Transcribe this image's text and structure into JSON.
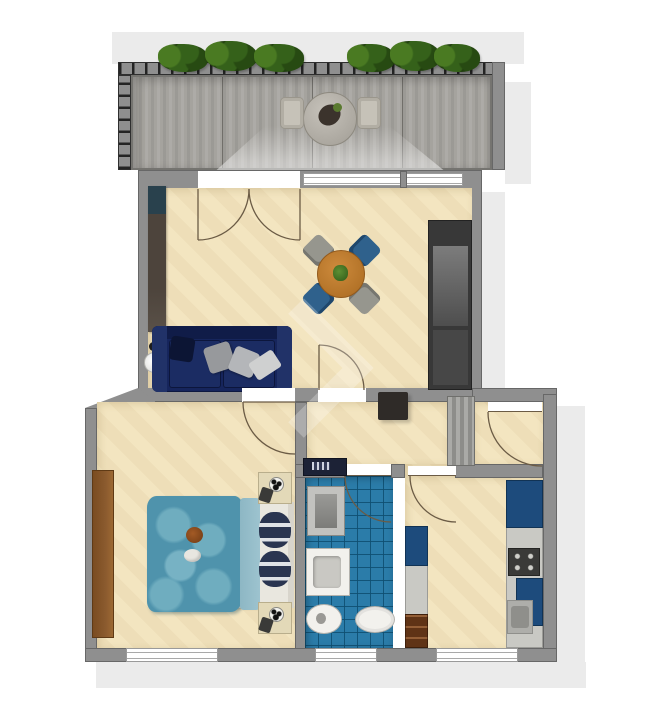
{
  "plan": {
    "view": "top-down 3D rendered apartment floor plan, no text labels",
    "rooms": [
      {
        "id": "balcony",
        "label": "Balcony",
        "items": [
          "wood plank decking",
          "railing with 6 planter boxes of greenery",
          "round bistro table with tray",
          "2 outdoor chairs"
        ]
      },
      {
        "id": "living-room",
        "label": "Living room",
        "items": [
          "navy three-seat sofa with gray cushions and white throw",
          "round wood dining table with centerpiece plant",
          "4 dining chairs (2 gray, 2 blue)",
          "dark sideboard along left wall",
          "white floor lamp",
          "dark built-in niche on right wall"
        ]
      },
      {
        "id": "bedroom",
        "label": "Bedroom",
        "items": [
          "double bed with teal patterned duvet",
          "light folded blanket",
          "2 navy striped pillows",
          "2 nightstands with spotted lamps",
          "tall brown wardrobe on left wall",
          "plush toys on bed"
        ]
      },
      {
        "id": "bathroom",
        "label": "Bathroom",
        "items": [
          "blue mosaic tile floor",
          "washing machine",
          "shower",
          "washbasin vanity",
          "bidet",
          "toilet"
        ]
      },
      {
        "id": "kitchen",
        "label": "Kitchen",
        "items": [
          "blue tall cabinet",
          "cooktop with knobs",
          "sink",
          "blue base cabinet",
          "gray counter run",
          "brown drawer unit"
        ]
      },
      {
        "id": "hallway",
        "label": "Hallway",
        "items": [
          "striped utility shaft",
          "dark wall cabinet"
        ]
      }
    ],
    "doors": [
      {
        "between": [
          "balcony",
          "living-room"
        ],
        "type": "double french door, both leaves swing into living room"
      },
      {
        "between": [
          "living-room",
          "hallway"
        ],
        "type": "single swing into living room"
      },
      {
        "between": [
          "living-room",
          "bedroom"
        ],
        "type": "single swing into bedroom"
      },
      {
        "between": [
          "hallway",
          "bathroom"
        ],
        "type": "single swing into bathroom"
      },
      {
        "between": [
          "hallway",
          "kitchen"
        ],
        "type": "single swing into kitchen"
      },
      {
        "between": [
          "hallway",
          "corridor"
        ],
        "type": "single swing into corridor"
      }
    ],
    "windows": [
      {
        "room": "living-room",
        "note": "wide glazing strip to balcony with mullion"
      },
      {
        "room": "bedroom",
        "wall": "bottom"
      },
      {
        "room": "bathroom",
        "wall": "bottom"
      },
      {
        "room": "kitchen",
        "wall": "bottom"
      }
    ],
    "watermark": "faint white chevron over living room door area"
  },
  "colors": {
    "wall": "#8f8f8f",
    "wallDark": "#4a4a4a",
    "floorBeige": "#f3e5c0",
    "deck": "#a5a39e",
    "tileBlue": "#2b7ca9",
    "sofaNavy": "#16255c",
    "tableWood": "#bf7c2e",
    "chairBlue": "#2f618c",
    "chairGray": "#96968e",
    "cabinetBlue": "#1d4b7c",
    "cabinetBrown": "#5f3316",
    "counterGray": "#c9c9c4",
    "wardrobe": "#8a5a2e",
    "duvet": "#4f93ac",
    "duvetLight": "#9dc3cf",
    "pillowNavy": "#2a3550",
    "shadow": "#ebebeb",
    "plantDark": "#203d0e",
    "plantMid": "#35611a",
    "plantLight": "#4a7a22",
    "arc": "#6b5b45"
  }
}
